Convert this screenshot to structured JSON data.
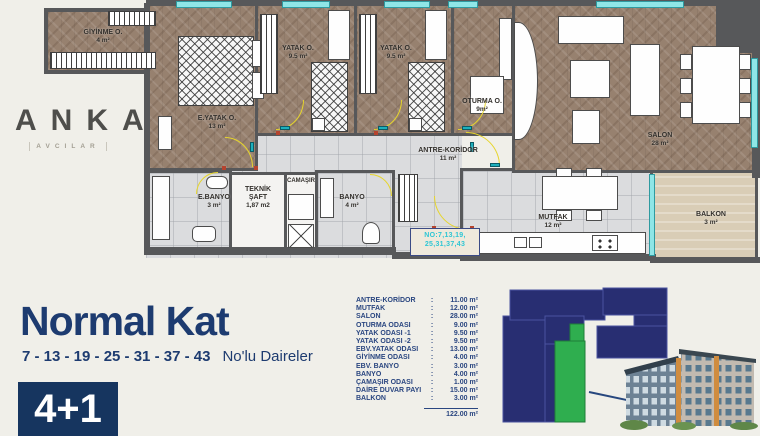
{
  "brand": {
    "letters": [
      "A",
      "N",
      "K",
      "A"
    ],
    "sub": "AVCILAR"
  },
  "plan": {
    "rooms": [
      {
        "name": "GİYİNME O.",
        "area": "4 m²"
      },
      {
        "name": "E.YATAK O.",
        "area": "13 m²"
      },
      {
        "name": "YATAK O.",
        "area": "9.5 m²"
      },
      {
        "name": "YATAK O.",
        "area": "9.5 m²"
      },
      {
        "name": "OTURMA O.",
        "area": "9m²"
      },
      {
        "name": "SALON",
        "area": "28 m²"
      },
      {
        "name": "ANTRE-KORİDOR",
        "area": "11 m²"
      },
      {
        "name": "E.BANYO",
        "area": "3 m²"
      },
      {
        "name": "TEKNİK ŞAFT",
        "area": "1,87 m2"
      },
      {
        "name": "CAMAŞIR",
        "area": ""
      },
      {
        "name": "BANYO",
        "area": "4 m²"
      },
      {
        "name": "MUTFAK",
        "area": "12 m²"
      },
      {
        "name": "BALKON",
        "area": "3 m²"
      }
    ],
    "unit_no": {
      "line1": "NO:7,13,19,",
      "line2": "25,31,37,43"
    }
  },
  "footer": {
    "title": "Normal Kat",
    "subtitle_numbers": "7 - 13 - 19 - 25 - 31 - 37 - 43",
    "subtitle_text": "No'lu Daireler",
    "badge": "4+1"
  },
  "area_table": {
    "colon": ":",
    "rows": [
      {
        "label": "ANTRE-KORİDOR",
        "value": "11.00 m²"
      },
      {
        "label": "MUTFAK",
        "value": "12.00 m²"
      },
      {
        "label": "SALON",
        "value": "28.00 m²"
      },
      {
        "label": "OTURMA ODASI",
        "value": "9.00 m²"
      },
      {
        "label": "YATAK ODASI -1",
        "value": "9.50 m²"
      },
      {
        "label": "YATAK ODASI -2",
        "value": "9.50 m²"
      },
      {
        "label": "EBV.YATAK ODASI",
        "value": "13.00 m²"
      },
      {
        "label": "GİYİNME ODASI",
        "value": "4.00 m²"
      },
      {
        "label": "EBV. BANYO",
        "value": "3.00 m²"
      },
      {
        "label": "BANYO",
        "value": "4.00 m²"
      },
      {
        "label": "ÇAMAŞIR ODASI",
        "value": "1.00 m²"
      },
      {
        "label": "DAİRE DUVAR PAYI",
        "value": "15.00 m²"
      },
      {
        "label": "BALKON",
        "value": "3.00 m²"
      }
    ],
    "total": "122.00 m²"
  },
  "colors": {
    "navy": "#1d3b70",
    "keyplan_navy": "#282e72",
    "highlight_green": "#2fae4f",
    "window_cyan": "#8fe6e7",
    "wall_gray": "#57585a"
  }
}
